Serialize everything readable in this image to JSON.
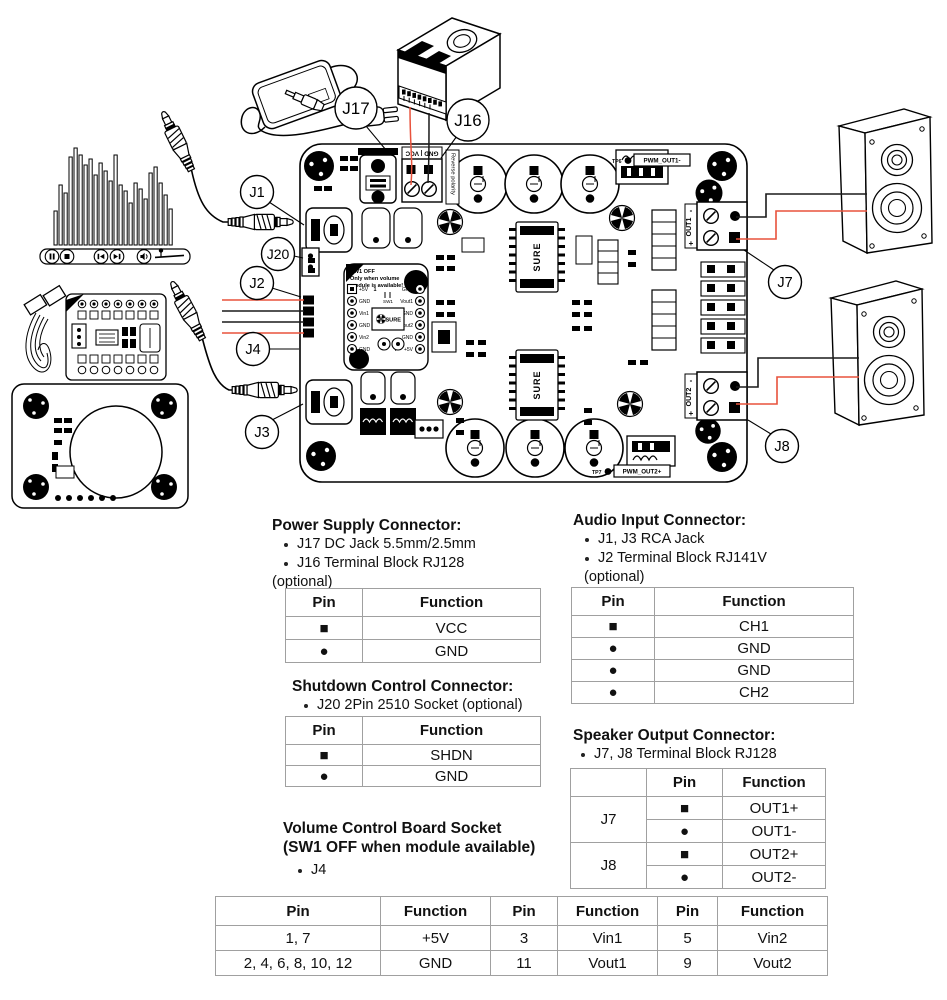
{
  "diagram": {
    "callouts": {
      "j1": "J1",
      "j2": "J2",
      "j3": "J3",
      "j4": "J4",
      "j7": "J7",
      "j8": "J8",
      "j16": "J16",
      "j17": "J17",
      "j20": "J20"
    },
    "board": {
      "power_terminal_label": "GND | VCC",
      "reverse_polarity": "Reverse polarity",
      "sw1_note_1": "SW1 OFF",
      "sw1_note_2": "Only when volume",
      "sw1_note_3": "module is available!",
      "sw1_label": "SW1",
      "pin1_red": "1",
      "pin7_red": "7",
      "j4_left": [
        "+5V",
        "GND",
        "Vin1",
        "GND",
        "Vin2",
        "GND"
      ],
      "j4_right": [
        "GND",
        "Vout1",
        "GND",
        "Vout2",
        "GND",
        "+5V"
      ],
      "chip_brand": "SURE",
      "logo_text": "SURE",
      "out1_label": "OUT1",
      "out2_label": "OUT2",
      "plus": "+",
      "minus": "-",
      "tp6": "TP6",
      "tp7": "TP7",
      "pwm_out1": "PWM_OUT1-",
      "pwm_out2": "PWM_OUT2+"
    }
  },
  "sections": {
    "power_supply": {
      "title": "Power Supply Connector:",
      "bullets": [
        "J17 DC Jack 5.5mm/2.5mm",
        "J16 Terminal Block RJ128"
      ],
      "optional_note": "(optional)",
      "table": {
        "headers": [
          "Pin",
          "Function"
        ],
        "rows": [
          [
            "■",
            "VCC"
          ],
          [
            "●",
            "GND"
          ]
        ]
      }
    },
    "audio_input": {
      "title": "Audio Input Connector:",
      "bullets": [
        "J1, J3 RCA Jack",
        "J2 Terminal Block RJ141V"
      ],
      "optional_note": "(optional)",
      "table": {
        "headers": [
          "Pin",
          "Function"
        ],
        "rows": [
          [
            "■",
            "CH1"
          ],
          [
            "●",
            "GND"
          ],
          [
            "●",
            "GND"
          ],
          [
            "●",
            "CH2"
          ]
        ]
      }
    },
    "shutdown": {
      "title": "Shutdown Control Connector:",
      "bullet": "J20 2Pin 2510 Socket (optional)",
      "table": {
        "headers": [
          "Pin",
          "Function"
        ],
        "rows": [
          [
            "■",
            "SHDN"
          ],
          [
            "●",
            "GND"
          ]
        ]
      }
    },
    "speaker_output": {
      "title": "Speaker Output Connector:",
      "bullet": "J7, J8 Terminal Block RJ128",
      "table": {
        "headers": [
          "",
          "Pin",
          "Function"
        ],
        "groups": [
          {
            "name": "J7",
            "rows": [
              [
                "■",
                "OUT1+"
              ],
              [
                "●",
                "OUT1-"
              ]
            ]
          },
          {
            "name": "J8",
            "rows": [
              [
                "■",
                "OUT2+"
              ],
              [
                "●",
                "OUT2-"
              ]
            ]
          }
        ]
      }
    },
    "volume_socket": {
      "title_line1": "Volume Control Board Socket",
      "title_line2": "(SW1 OFF when module available)",
      "bullet": "J4"
    }
  },
  "pin_table": {
    "headers": [
      "Pin",
      "Function",
      "Pin",
      "Function",
      "Pin",
      "Function"
    ],
    "rows": [
      [
        "1, 7",
        "+5V",
        "3",
        "Vin1",
        "5",
        "Vin2"
      ],
      [
        "2, 4, 6, 8, 10, 12",
        "GND",
        "11",
        "Vout1",
        "9",
        "Vout2"
      ]
    ]
  },
  "colors": {
    "wire_red": "#e8523c",
    "silk_red": "#cc1f1a"
  }
}
